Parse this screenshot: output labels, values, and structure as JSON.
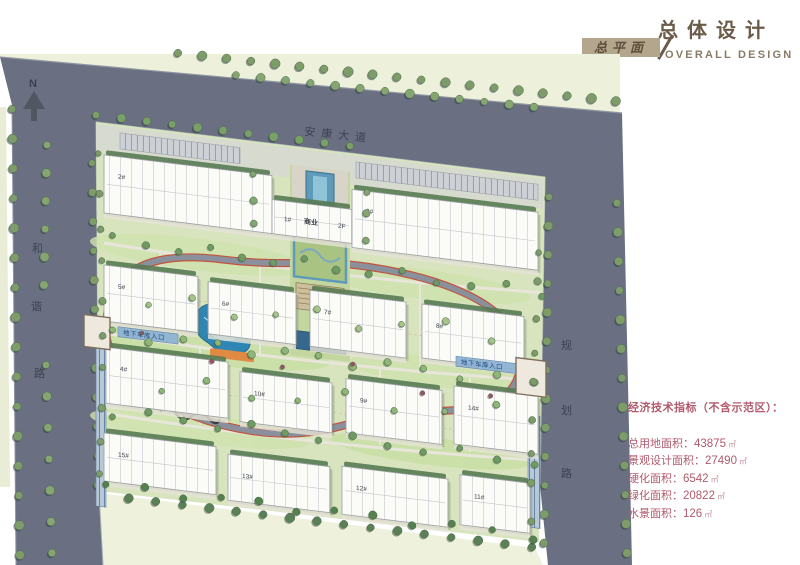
{
  "header": {
    "title_cn": "总体设计",
    "title_en": "OVERALL  DESIGN",
    "badge": "总平面"
  },
  "plan": {
    "north_label": "N",
    "roads": {
      "top": "安康大道",
      "left": "和谐路",
      "right": "规划路"
    },
    "signs": {
      "garage_west": "地下车库入口",
      "garage_east": "地下车库入口"
    },
    "buildings": {
      "commercial_label": "商业",
      "floors_label": "2F",
      "numbers": [
        "2#",
        "1#",
        "3#",
        "5#",
        "6#",
        "7#",
        "8#",
        "4#",
        "10#",
        "9#",
        "14#",
        "15#",
        "13#",
        "12#",
        "11#"
      ]
    }
  },
  "indicators": {
    "title": "经济技术指标（不含示范区）：",
    "items": [
      {
        "label": "总用地面积：",
        "value": "43875",
        "unit": "㎡"
      },
      {
        "label": "景观设计面积：",
        "value": "27490",
        "unit": "㎡"
      },
      {
        "label": "硬化面积：",
        "value": "6542",
        "unit": "㎡"
      },
      {
        "label": "绿化面积：",
        "value": "20822",
        "unit": "㎡"
      },
      {
        "label": "水景面积：",
        "value": "126",
        "unit": "㎡"
      }
    ]
  },
  "colors": {
    "road": "#6a7082",
    "site_green": "#d8e4bd",
    "pale_margin": "#edf0da",
    "water": "#2f86b5",
    "jogging_red": "#c2543e",
    "indicator_text": "#b05a6c",
    "header_brown": "#6b5b49",
    "badge_bg": "#b3a68c",
    "tree_green": "#7d9c6a"
  }
}
